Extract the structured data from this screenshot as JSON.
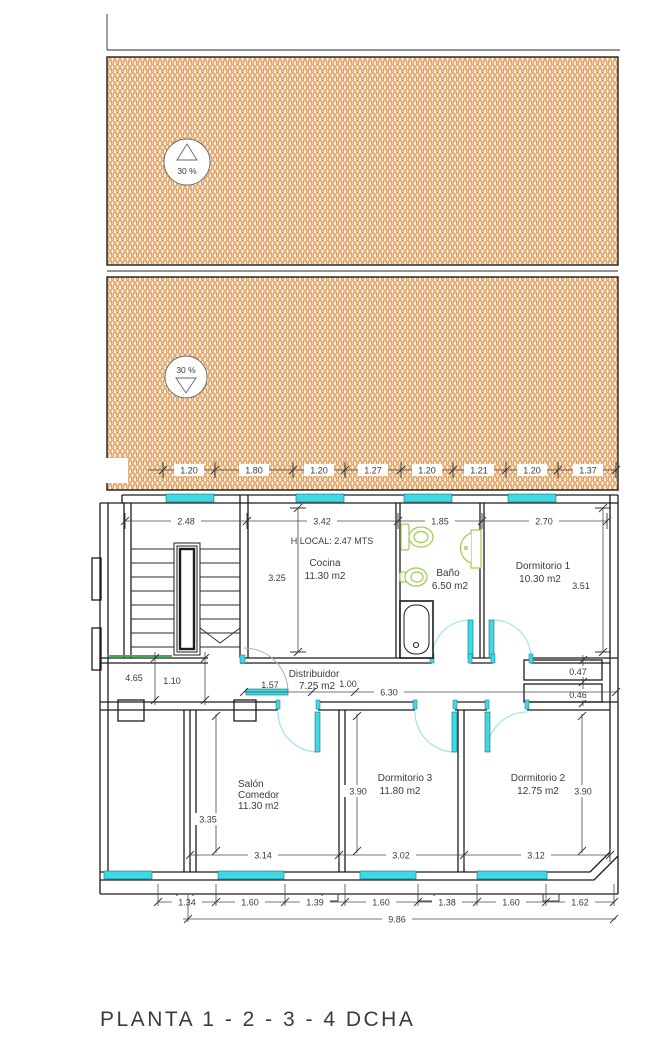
{
  "title": "PLANTA 1 - 2 - 3 - 4 DCHA",
  "ceiling_note": "H LOCAL: 2.47 MTS",
  "ramps": {
    "upper_slope": "30 %",
    "lower_slope": "30 %"
  },
  "rooms": {
    "cocina": {
      "name": "Cocina",
      "area": "11.30 m2"
    },
    "bano": {
      "name": "Baño",
      "area": "6.50 m2"
    },
    "dormitorio1": {
      "name": "Dormitorio 1",
      "area": "10.30 m2"
    },
    "distribuidor": {
      "name": "Distribuidor",
      "area": "7.25 m2"
    },
    "salon_comedor": {
      "name_line1": "Salón",
      "name_line2": "Comedor",
      "area": "11.30 m2"
    },
    "dormitorio3": {
      "name": "Dormitorio 3",
      "area": "11.80 m2"
    },
    "dormitorio2": {
      "name": "Dormitorio 2",
      "area": "12.75 m2"
    }
  },
  "dimensions": {
    "top_row": [
      "1.20",
      "1.80",
      "1.20",
      "1.27",
      "1.20",
      "1.21",
      "1.20",
      "1.37"
    ],
    "stairwell_width": "2.48",
    "cocina_width": "3.42",
    "bano_width": "1.85",
    "dorm1_width": "2.70",
    "cocina_depth": "3.25",
    "dorm1_depth": "3.51",
    "shaft_upper": "0.47",
    "shaft_lower": "0.46",
    "stair_depth": "4.65",
    "stair_exit_width": "1.10",
    "hall_segment": "1.57",
    "hall_door": "1.00",
    "hall_length": "6.30",
    "salon_depth": "3.35",
    "dorm3_depth": "3.90",
    "dorm2_depth": "3.90",
    "salon_width": "3.14",
    "dorm3_width": "3.02",
    "dorm2_width": "3.12",
    "bottom_row": [
      "1.34",
      "1.60",
      "1.39",
      "1.60",
      "1.38",
      "1.60",
      "1.62"
    ],
    "total_width": "9.86"
  },
  "colors": {
    "hatch": "#d8883b",
    "window": "#3fe2ec",
    "door": "#62dde8",
    "fixture": "#9ccc4e",
    "line": "#1c1c1c"
  }
}
